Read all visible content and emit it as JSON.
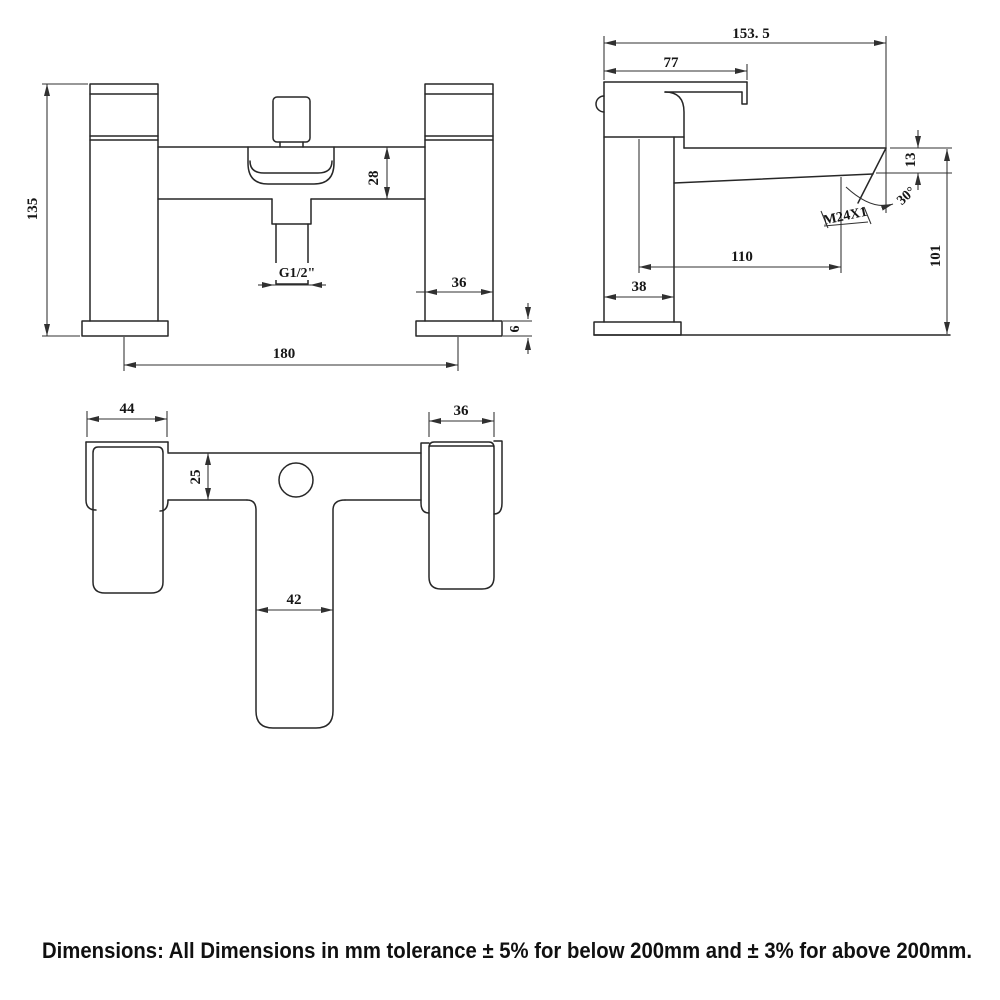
{
  "caption": "Dimensions: All Dimensions in mm tolerance ± 5% for below 200mm and ± 3% for above 200mm.",
  "front_view": {
    "height": "135",
    "spout_block_height": "28",
    "shower_outlet_thread": "G1/2\"",
    "pillar_width": "36",
    "base_height": "6",
    "tap_centres": "180"
  },
  "side_view": {
    "total_depth": "153. 5",
    "handle_length": "77",
    "spout_tip_drop": "13",
    "spout_tip_angle": "30°",
    "spout_tip_thread": "M24X1",
    "spout_reach": "110",
    "spout_height": "101",
    "body_depth": "38"
  },
  "plan_view": {
    "handle_block_width": "44",
    "body_block_width": "36",
    "deck_depth": "25",
    "stem_width": "42"
  }
}
